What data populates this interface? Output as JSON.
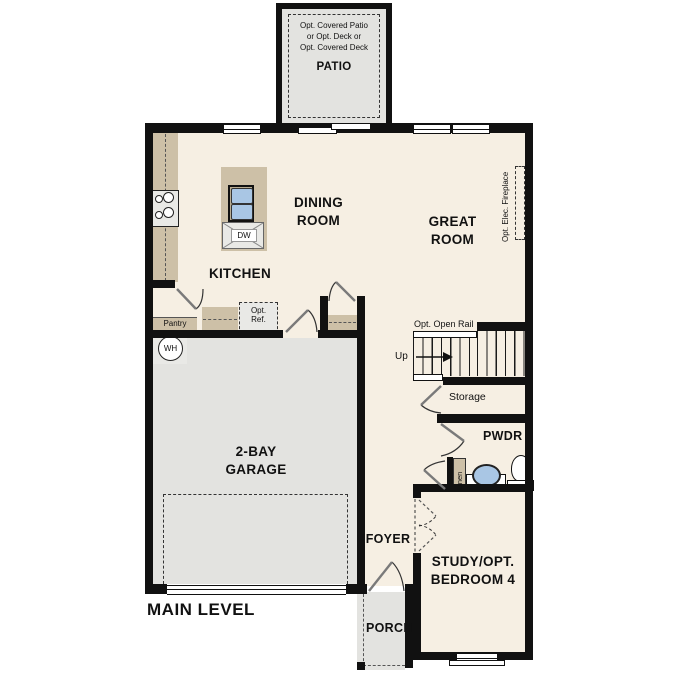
{
  "title": "MAIN LEVEL",
  "patio": {
    "note1": "Opt. Covered Patio",
    "note2": "or Opt. Deck or",
    "note3": "Opt. Covered Deck",
    "label": "PATIO"
  },
  "rooms": {
    "kitchen": "KITCHEN",
    "dining1": "DINING",
    "dining2": "ROOM",
    "great1": "GREAT",
    "great2": "ROOM",
    "garage1": "2-BAY",
    "garage2": "GARAGE",
    "foyer": "FOYER",
    "study1": "STUDY/OPT.",
    "study2": "BEDROOM 4",
    "powder": "PWDR",
    "porch": "PORCH",
    "storage": "Storage",
    "pantry": "Pantry",
    "linen": "Linen"
  },
  "annotations": {
    "open_rail": "Opt. Open Rail",
    "up": "Up",
    "fireplace": "Opt. Elec. Fireplace",
    "opt_ref1": "Opt.",
    "opt_ref2": "Ref.",
    "dishwasher": "DW",
    "water_heater": "WH"
  },
  "colors": {
    "wall": "#111111",
    "floor": "#f6efe3",
    "hard_floor": "#e3e3e0",
    "counter": "#cdc0a7",
    "sink_blue": "#a9c6e4",
    "appliance": "#e9e9e6"
  }
}
